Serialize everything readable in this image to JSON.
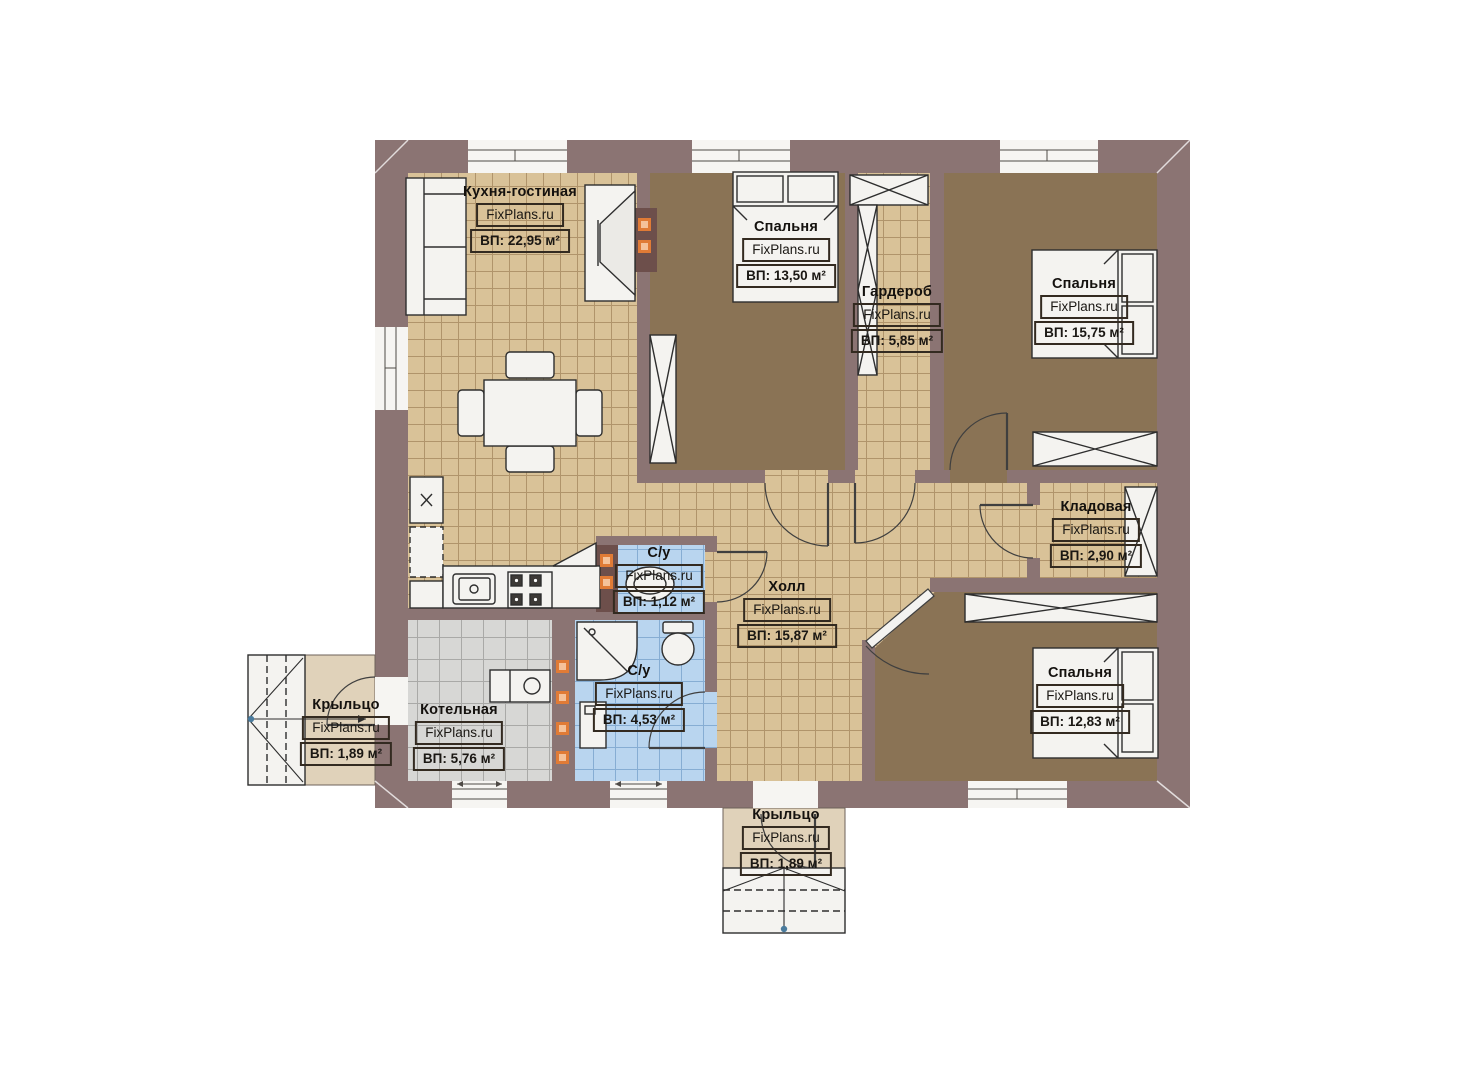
{
  "site": {
    "watermark": "FixPlans.ru"
  },
  "rooms": [
    {
      "id": "kitchen-living",
      "name": "Кухня-гостиная",
      "area": "ВП: 22,95 м²"
    },
    {
      "id": "bedroom-1",
      "name": "Спальня",
      "area": "ВП: 13,50 м²"
    },
    {
      "id": "wardrobe",
      "name": "Гардероб",
      "area": "ВП: 5,85 м²"
    },
    {
      "id": "bedroom-2",
      "name": "Спальня",
      "area": "ВП: 15,75 м²"
    },
    {
      "id": "pantry",
      "name": "Кладовая",
      "area": "ВП: 2,90 м²"
    },
    {
      "id": "hall",
      "name": "Холл",
      "area": "ВП: 15,87 м²"
    },
    {
      "id": "bedroom-3",
      "name": "Спальня",
      "area": "ВП: 12,83 м²"
    },
    {
      "id": "boiler-room",
      "name": "Котельная",
      "area": "ВП: 5,76 м²"
    },
    {
      "id": "bathroom-small",
      "name": "С/у",
      "area": "ВП: 1,12 м²"
    },
    {
      "id": "bathroom-big",
      "name": "С/у",
      "area": "ВП: 4,53 м²"
    },
    {
      "id": "porch-left",
      "name": "Крыльцо",
      "area": "ВП: 1,89 м²"
    },
    {
      "id": "porch-bottom",
      "name": "Крыльцо",
      "area": "ВП: 1,89 м²"
    }
  ],
  "colors": {
    "wall": "#8b7473",
    "tile_beige": "#d9c298",
    "floor_brown": "#8a7355",
    "tile_blue": "#b9d5ef",
    "tile_gray": "#d7d7d5",
    "porch": "#e0d2ba",
    "marker_orange": "#e07b36"
  }
}
